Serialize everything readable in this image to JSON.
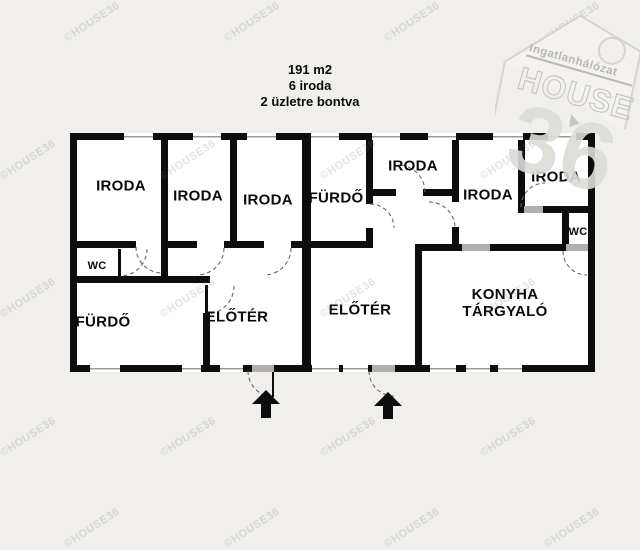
{
  "title": {
    "line1": "191 m2",
    "line2": "6 iroda",
    "line3": "2 üzletre bontva"
  },
  "rooms": {
    "iroda1": "IRODA",
    "iroda2": "IRODA",
    "iroda3": "IRODA",
    "iroda4": "IRODA",
    "iroda5": "IRODA",
    "iroda6": "IRODA",
    "furdo1": "FÜRDŐ",
    "furdo2": "FÜRDŐ",
    "wc1": "WC",
    "wc2": "WC",
    "eloter1": "ELŐTÉR",
    "eloter2": "ELŐTÉR",
    "konyha_line1": "KONYHA",
    "konyha_line2": "TÁRGYALÓ"
  },
  "logo": {
    "network": "Ingatlanhálózat",
    "brand": "HOUSE",
    "number": "36"
  },
  "watermark": {
    "text": "©HOUSE36",
    "positions": [
      [
        92,
        22
      ],
      [
        252,
        22
      ],
      [
        412,
        22
      ],
      [
        572,
        22
      ],
      [
        28,
        160
      ],
      [
        188,
        160
      ],
      [
        348,
        160
      ],
      [
        508,
        160
      ],
      [
        28,
        298
      ],
      [
        188,
        298
      ],
      [
        348,
        298
      ],
      [
        508,
        298
      ],
      [
        28,
        437
      ],
      [
        188,
        437
      ],
      [
        348,
        437
      ],
      [
        508,
        437
      ],
      [
        92,
        528
      ],
      [
        252,
        528
      ],
      [
        412,
        528
      ],
      [
        572,
        528
      ]
    ]
  },
  "colors": {
    "background": "#f0efeb",
    "wall": "#0d0d0d",
    "room_fill": "#ffffff",
    "door_sill_gray": "#b0afab",
    "window_line_gray": "#9a9995",
    "arc_gray": "#666666",
    "logo_gray": "#c6c5c0",
    "logo_number_gray": "#dcdbd6"
  }
}
